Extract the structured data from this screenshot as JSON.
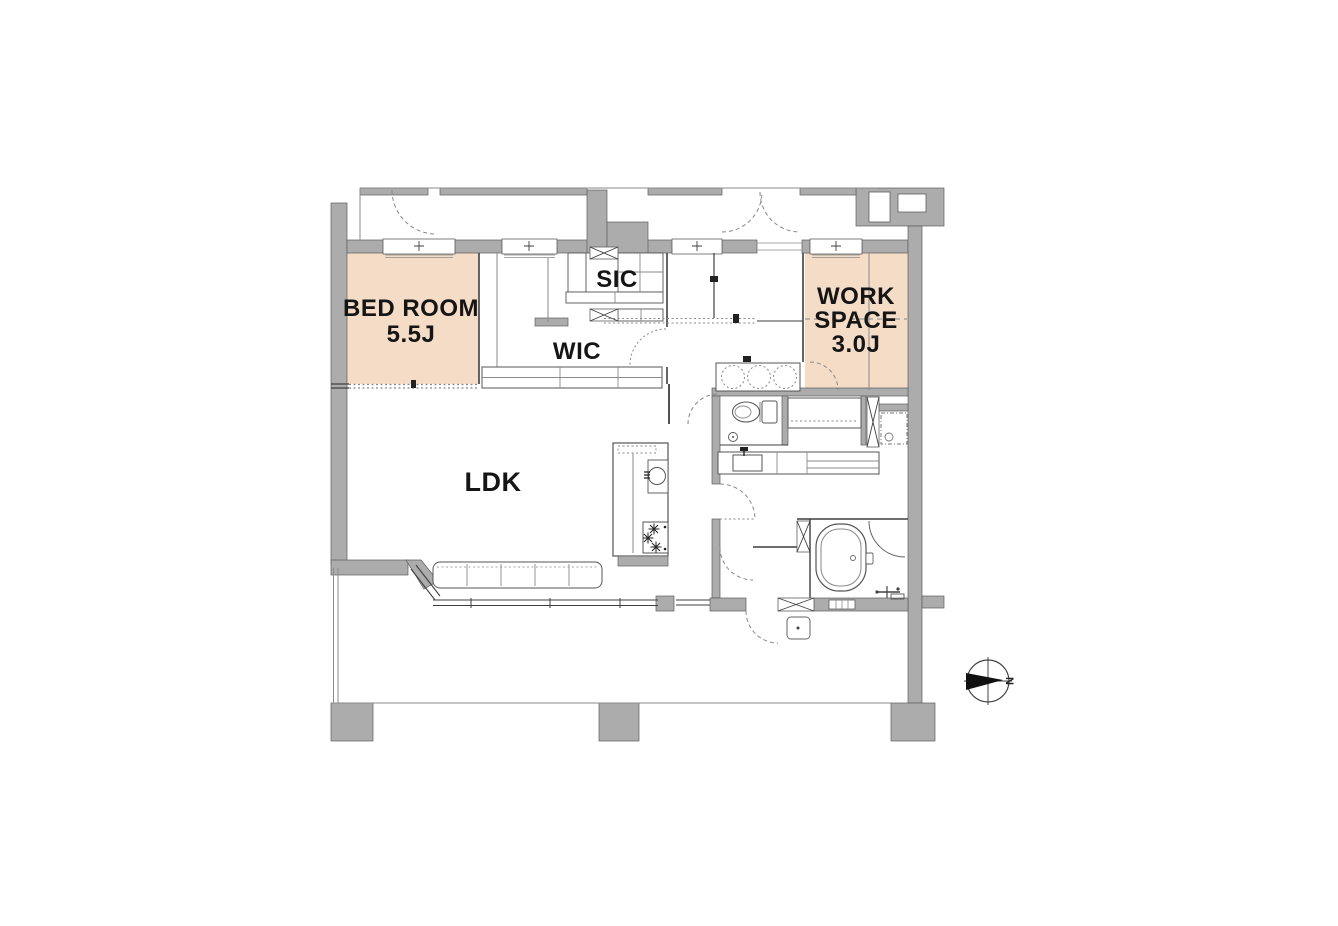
{
  "floorplan": {
    "rooms": {
      "bedroom": {
        "name": "BED ROOM",
        "size": "5.5J"
      },
      "sic": {
        "name": "SIC"
      },
      "wic": {
        "name": "WIC"
      },
      "workspace": {
        "line1": "WORK",
        "line2": "SPACE",
        "line3": "3.0J"
      },
      "ldk": {
        "name": "LDK"
      }
    },
    "compass": {
      "north_label": "N"
    },
    "colors": {
      "wall_gray": "#acacac",
      "room_highlight": "#f4dcc6",
      "line_dark": "#444444",
      "background": "#ffffff"
    }
  }
}
